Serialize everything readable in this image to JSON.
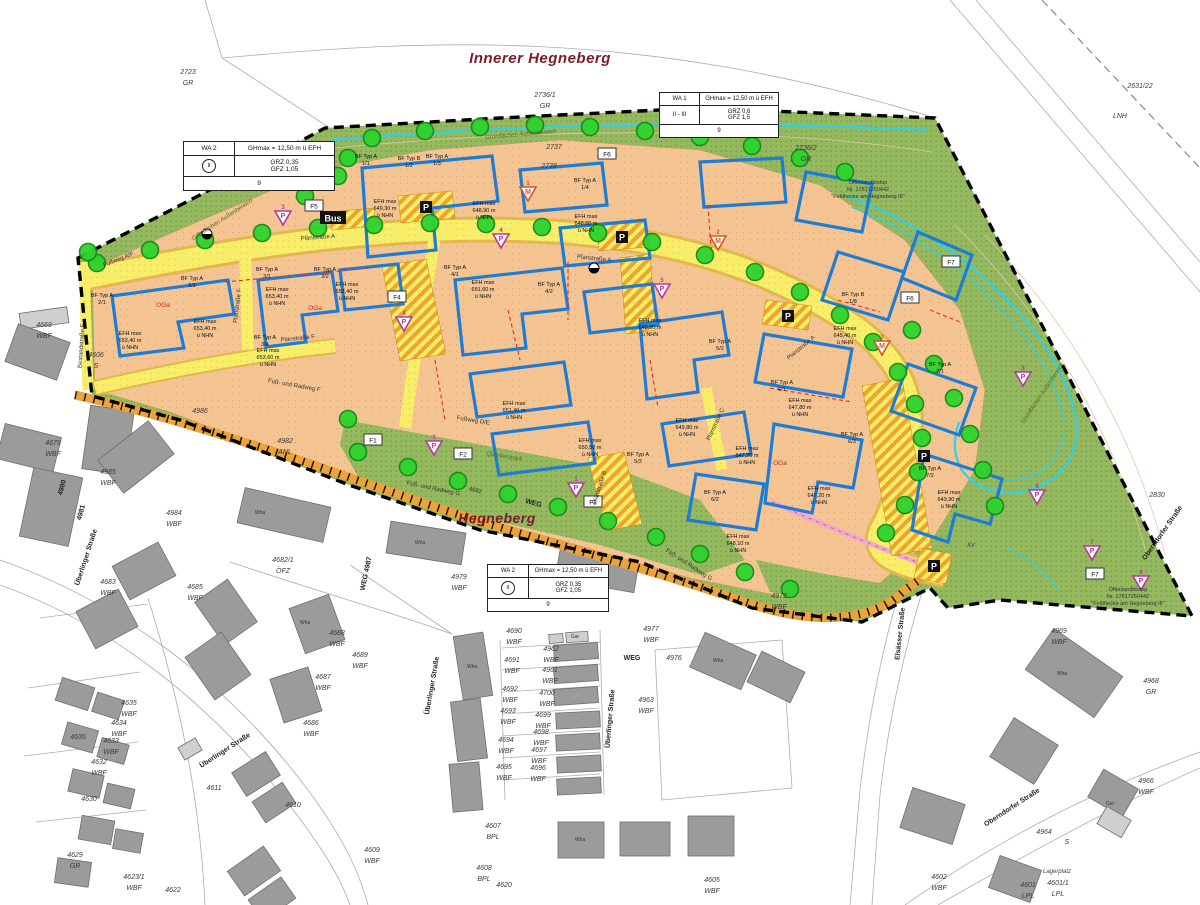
{
  "titles": {
    "main": {
      "text": "Innerer Hegneberg",
      "x": 540,
      "y": 63
    },
    "secondary": {
      "text": "Hegneberg",
      "x": 497,
      "y": 523
    }
  },
  "legends": [
    {
      "zone": "WA 2",
      "gh_label": "GHmax",
      "gh_value": "= 12,50 m ü EFH",
      "storeys": "II",
      "storeys_circled": true,
      "grz": "GRZ 0,35",
      "gfz": "GFZ 1,05",
      "units": "9"
    },
    {
      "zone": "WA 1",
      "gh_label": "GHmax",
      "gh_value": "= 12,50 m ü EFH",
      "storeys": "II - III",
      "storeys_circled": false,
      "grz": "GRZ 0,6",
      "gfz": "GFZ 1,5",
      "units": "9"
    },
    {
      "zone": "WA 2",
      "gh_label": "GHmax",
      "gh_value": "= 12,50 m ü EFH",
      "storeys": "II",
      "storeys_circled": true,
      "grz": "GRZ 0,35",
      "gfz": "GFZ 1,05",
      "units": "9"
    }
  ],
  "colors": {
    "plot_land": "#f4c493",
    "road_yellow": "#f8ee6a",
    "road_edge": "#e2b84e",
    "path_band": "#eba33a",
    "green_area": "#95b95e",
    "tree_fill": "#2ed32e",
    "tree_stroke": "#148a14",
    "building_gray": "#9b9b9b",
    "blue_outline": "#1e7cd4",
    "cyan_line": "#2fd0e8",
    "red_dash": "#e03020",
    "magenta_marker": "#b5399b",
    "orange_marker": "#d9531e",
    "title_red": "#7a1b2b",
    "pink_path": "#f0a8cc"
  },
  "parcels": {
    "format": "[number, use, x, y]",
    "items": [
      [
        "2723",
        "GR",
        188,
        74
      ],
      [
        "2736/1",
        "GR",
        545,
        97
      ],
      [
        "2736/2",
        "GR",
        806,
        150
      ],
      [
        "2631/22",
        "",
        1140,
        88
      ],
      [
        "LNH",
        "",
        1120,
        118
      ],
      [
        "2737",
        "",
        554,
        149
      ],
      [
        "2738",
        "",
        549,
        168
      ],
      [
        "2830",
        "",
        1157,
        497
      ],
      [
        "4606",
        "S",
        96,
        357
      ],
      [
        "4669",
        "WBF",
        44,
        327
      ],
      [
        "4679",
        "WBF",
        53,
        445
      ],
      [
        "4985",
        "WBF",
        108,
        474
      ],
      [
        "4984",
        "WBF",
        174,
        515
      ],
      [
        "4986",
        "",
        200,
        413
      ],
      [
        "4982",
        "ANL",
        285,
        443
      ],
      [
        "4683",
        "WBF",
        108,
        584
      ],
      [
        "4685",
        "WBF",
        195,
        589
      ],
      [
        "4682/1",
        "ÖFZ",
        283,
        562
      ],
      [
        "4688",
        "WBF",
        337,
        635
      ],
      [
        "4689",
        "WBF",
        360,
        657
      ],
      [
        "4687",
        "WBF",
        323,
        679
      ],
      [
        "4686",
        "WBF",
        311,
        725
      ],
      [
        "4635",
        "WBF",
        129,
        705
      ],
      [
        "4634",
        "WBF",
        119,
        725
      ],
      [
        "4636",
        "",
        78,
        739
      ],
      [
        "4633",
        "WBF",
        111,
        743
      ],
      [
        "4632",
        "WBF",
        99,
        764
      ],
      [
        "4630",
        "",
        89,
        801
      ],
      [
        "4629",
        "GR",
        75,
        857
      ],
      [
        "4623/1",
        "WBF",
        134,
        879
      ],
      [
        "4622",
        "",
        173,
        892
      ],
      [
        "4611",
        "",
        214,
        790
      ],
      [
        "4610",
        "",
        293,
        807
      ],
      [
        "4609",
        "WBF",
        372,
        852
      ],
      [
        "4607",
        "BPL",
        493,
        828
      ],
      [
        "4608",
        "BPL",
        484,
        870
      ],
      [
        "4620",
        "",
        504,
        887
      ],
      [
        "4605",
        "WBF",
        712,
        882
      ],
      [
        "4690",
        "WBF",
        514,
        633
      ],
      [
        "4691",
        "WBF",
        512,
        662
      ],
      [
        "4692",
        "WBF",
        510,
        691
      ],
      [
        "4693",
        "WBF",
        508,
        713
      ],
      [
        "4694",
        "WBF",
        506,
        742
      ],
      [
        "4695",
        "WBF",
        504,
        769
      ],
      [
        "4962",
        "WBF",
        551,
        651
      ],
      [
        "4961",
        "WBF",
        550,
        672
      ],
      [
        "4700",
        "WBF",
        547,
        695
      ],
      [
        "4699",
        "WBF",
        543,
        717
      ],
      [
        "4698",
        "WBF",
        541,
        734
      ],
      [
        "4697",
        "WBF",
        539,
        752
      ],
      [
        "4696",
        "WBF",
        538,
        770
      ],
      [
        "4963",
        "WBF",
        646,
        702
      ],
      [
        "4976",
        "",
        674,
        660
      ],
      [
        "4977",
        "WBF",
        651,
        631
      ],
      [
        "4979",
        "WBF",
        459,
        579
      ],
      [
        "4973",
        "WBF",
        779,
        598
      ],
      [
        "4969",
        "WBF",
        1059,
        633
      ],
      [
        "4968",
        "GR",
        1151,
        683
      ],
      [
        "4966",
        "WBF",
        1146,
        783
      ],
      [
        "4964",
        "",
        1044,
        834
      ],
      [
        "S",
        "",
        1067,
        844
      ],
      [
        "4601/1",
        "LPL",
        1058,
        885
      ],
      [
        "4601",
        "LPL",
        1028,
        887
      ],
      [
        "4602",
        "WBF",
        939,
        879
      ]
    ]
  },
  "streets": {
    "format": "[label, x, y, rotation]",
    "items": [
      [
        "Überlinger Straße",
        88,
        558,
        -72
      ],
      [
        "Überlinger Straße",
        226,
        752,
        -33
      ],
      [
        "Überlinger Straße",
        434,
        686,
        -80
      ],
      [
        "Überlinger Straße",
        612,
        719,
        -85
      ],
      [
        "Oberndorfer Straße",
        1164,
        534,
        -55
      ],
      [
        "Oberndorfer Straße",
        1013,
        809,
        -33
      ],
      [
        "Elsässer Straße",
        902,
        634,
        -84
      ],
      [
        "WEG 4987",
        368,
        574,
        -78
      ],
      [
        "4980",
        64,
        488,
        -75
      ],
      [
        "4981",
        83,
        513,
        -75
      ],
      [
        "WEG",
        533,
        505,
        16
      ],
      [
        "WEG",
        632,
        660,
        0
      ]
    ]
  },
  "roads": {
    "format": "[label, x, y, rotation]",
    "items": [
      [
        "Planstraße A",
        318,
        239,
        -4
      ],
      [
        "Planstraße A",
        594,
        260,
        6
      ],
      [
        "Planstraße A",
        802,
        349,
        -40
      ],
      [
        "Planstraße F",
        298,
        340,
        -6
      ],
      [
        "Planstraße F",
        239,
        306,
        -83
      ],
      [
        "Bestandstraße F",
        83,
        346,
        -86
      ],
      [
        "Planstraße B",
        601,
        488,
        -72
      ],
      [
        "Planstraße C",
        717,
        425,
        -65
      ],
      [
        "Fußweg A/F",
        119,
        261,
        -22
      ],
      [
        "Fußweg D/E",
        473,
        422,
        9
      ],
      [
        "Fuß- und Radweg F",
        294,
        387,
        10
      ],
      [
        "Fuß- und Radweg G",
        433,
        490,
        12
      ],
      [
        "Fuß- und Radweg G",
        688,
        566,
        33
      ],
      [
        "4682",
        475,
        492,
        12
      ]
    ]
  },
  "notes": {
    "format": "[label, x, y, rotation, style]",
    "items": [
      [
        "Grünflächen Außenbereich",
        521,
        136,
        -5,
        "green"
      ],
      [
        "Grünflächen Außenbereich",
        223,
        221,
        -33,
        "green"
      ],
      [
        "Grünflächen Außenbereich",
        1044,
        394,
        -56,
        "green"
      ],
      [
        "Quartierspark",
        504,
        458,
        9,
        "green"
      ],
      [
        "Lagerplatz",
        1057,
        873,
        0,
        "gray"
      ],
      [
        "XV",
        971,
        547,
        0,
        "gray"
      ]
    ]
  },
  "biotop_note": {
    "lines": [
      "Offenlandbiotop",
      "Nr. 17817250442",
      "\"Feldhecke am Hegneberg III\""
    ],
    "positions": [
      {
        "x": 868,
        "y": 184
      },
      {
        "x": 1128,
        "y": 591
      }
    ]
  },
  "plots": {
    "format": "[type, id, x, y]",
    "items": [
      [
        "BF Typ A",
        "1/1",
        366,
        158
      ],
      [
        "BF Typ B",
        "1/2",
        409,
        160
      ],
      [
        "BF Typ A",
        "1/3",
        437,
        158
      ],
      [
        "BF Typ A",
        "1/4",
        585,
        182
      ],
      [
        "BF Typ B",
        "1/8",
        853,
        296
      ],
      [
        "BF Typ A",
        "2/1",
        102,
        297
      ],
      [
        "BF Typ A",
        "2/2",
        192,
        280
      ],
      [
        "BF Typ A",
        "3/1",
        267,
        271
      ],
      [
        "BF Typ A",
        "3/2",
        325,
        271
      ],
      [
        "BF Typ A",
        "3/4",
        265,
        339
      ],
      [
        "BF Typ A",
        "4/1",
        455,
        269
      ],
      [
        "BF Typ A",
        "4/2",
        549,
        286
      ],
      [
        "BF Typ A",
        "5/2",
        720,
        343
      ],
      [
        "BF Typ A",
        "5/3",
        638,
        456
      ],
      [
        "BF Typ A",
        "6/1",
        782,
        384
      ],
      [
        "BF Typ A",
        "6/2",
        715,
        494
      ],
      [
        "BF Typ A",
        "6/3",
        852,
        436
      ],
      [
        "BF Typ A",
        "7/1",
        940,
        366
      ],
      [
        "BF Typ A",
        "7/2",
        930,
        470
      ]
    ]
  },
  "efh_labels": {
    "format": "[value_m, x, y]",
    "prefix": "EFH max",
    "suffix": "ü NHN",
    "items": [
      [
        "649,30",
        385,
        203
      ],
      [
        "648,90",
        484,
        205
      ],
      [
        "648,60",
        586,
        218
      ],
      [
        "653,40",
        130,
        335
      ],
      [
        "653,40",
        205,
        323
      ],
      [
        "653,40",
        277,
        291
      ],
      [
        "653,40",
        347,
        286
      ],
      [
        "653,60",
        268,
        352
      ],
      [
        "651,60",
        483,
        284
      ],
      [
        "651,40",
        514,
        405
      ],
      [
        "650,50",
        590,
        442
      ],
      [
        "649,80",
        650,
        322
      ],
      [
        "649,80",
        687,
        422
      ],
      [
        "647,80",
        800,
        402
      ],
      [
        "647,20",
        747,
        450
      ],
      [
        "647,20",
        819,
        490
      ],
      [
        "648,10",
        738,
        538
      ],
      [
        "645,40",
        845,
        330
      ],
      [
        "643,90",
        949,
        494
      ]
    ]
  },
  "oga_labels": [
    [
      163,
      307
    ],
    [
      315,
      310
    ],
    [
      780,
      465
    ]
  ],
  "f_markers": [
    {
      "label": "F1",
      "x": 373,
      "y": 440
    },
    {
      "label": "F2",
      "x": 463,
      "y": 454
    },
    {
      "label": "F3",
      "x": 593,
      "y": 502
    },
    {
      "label": "F4",
      "x": 397,
      "y": 297
    },
    {
      "label": "F5",
      "x": 314,
      "y": 206
    },
    {
      "label": "F6",
      "x": 607,
      "y": 154
    },
    {
      "label": "F6",
      "x": 910,
      "y": 298
    },
    {
      "label": "F7",
      "x": 951,
      "y": 262
    },
    {
      "label": "F7",
      "x": 1095,
      "y": 574
    }
  ],
  "parking_badges": {
    "label": "P",
    "positions": [
      [
        426,
        207
      ],
      [
        622,
        237
      ],
      [
        788,
        316
      ],
      [
        924,
        456
      ],
      [
        934,
        566
      ]
    ]
  },
  "bus_badge": {
    "label": "Bus",
    "x": 333,
    "y": 218
  },
  "play_markers": {
    "format": "[x, y, letter, number, color]",
    "items": [
      [
        283,
        217,
        "P",
        "3",
        "magenta"
      ],
      [
        404,
        323,
        "P",
        "4",
        "magenta"
      ],
      [
        501,
        240,
        "P",
        "4",
        "magenta"
      ],
      [
        662,
        290,
        "P",
        "5",
        "magenta"
      ],
      [
        434,
        447,
        "P",
        "1",
        "magenta"
      ],
      [
        576,
        489,
        "P",
        "1",
        "magenta"
      ],
      [
        1023,
        378,
        "P",
        "3",
        "magenta"
      ],
      [
        1037,
        496,
        "P",
        "6",
        "magenta"
      ],
      [
        1092,
        552,
        "P",
        "7",
        "magenta"
      ],
      [
        1141,
        582,
        "P",
        "8",
        "magenta"
      ],
      [
        528,
        193,
        "M",
        "1",
        "orange"
      ],
      [
        718,
        242,
        "M",
        "2",
        "orange"
      ],
      [
        882,
        347,
        "M",
        "3",
        "orange"
      ]
    ]
  },
  "lamp_icons": [
    [
      207,
      234
    ],
    [
      594,
      268
    ]
  ],
  "building_labels": {
    "format": "[label, x, y]",
    "items": [
      [
        "Wha",
        260,
        514
      ],
      [
        "Wha",
        420,
        544
      ],
      [
        "Wha",
        305,
        624
      ],
      [
        "Wha",
        472,
        668
      ],
      [
        "Wha",
        1062,
        675
      ],
      [
        "Wha",
        718,
        662
      ],
      [
        "Wha",
        580,
        841
      ],
      [
        "Gar",
        575,
        638
      ],
      [
        "Gar",
        1110,
        805
      ]
    ]
  },
  "trees": [
    [
      348,
      158
    ],
    [
      372,
      138
    ],
    [
      425,
      131
    ],
    [
      480,
      127
    ],
    [
      535,
      125
    ],
    [
      590,
      127
    ],
    [
      645,
      131
    ],
    [
      700,
      137
    ],
    [
      752,
      146
    ],
    [
      800,
      158
    ],
    [
      845,
      172
    ],
    [
      97,
      263
    ],
    [
      150,
      250
    ],
    [
      205,
      240
    ],
    [
      262,
      233
    ],
    [
      318,
      228
    ],
    [
      374,
      225
    ],
    [
      430,
      223
    ],
    [
      486,
      224
    ],
    [
      542,
      227
    ],
    [
      598,
      233
    ],
    [
      652,
      242
    ],
    [
      705,
      255
    ],
    [
      755,
      272
    ],
    [
      800,
      292
    ],
    [
      840,
      315
    ],
    [
      873,
      342
    ],
    [
      898,
      372
    ],
    [
      915,
      404
    ],
    [
      922,
      438
    ],
    [
      918,
      472
    ],
    [
      905,
      505
    ],
    [
      886,
      533
    ],
    [
      358,
      452
    ],
    [
      408,
      467
    ],
    [
      458,
      481
    ],
    [
      508,
      494
    ],
    [
      558,
      507
    ],
    [
      608,
      521
    ],
    [
      656,
      537
    ],
    [
      700,
      554
    ],
    [
      745,
      572
    ],
    [
      790,
      589
    ],
    [
      348,
      419
    ],
    [
      912,
      330
    ],
    [
      934,
      364
    ],
    [
      954,
      398
    ],
    [
      970,
      434
    ],
    [
      983,
      470
    ],
    [
      995,
      506
    ],
    [
      88,
      252
    ],
    [
      305,
      196
    ],
    [
      338,
      176
    ]
  ]
}
